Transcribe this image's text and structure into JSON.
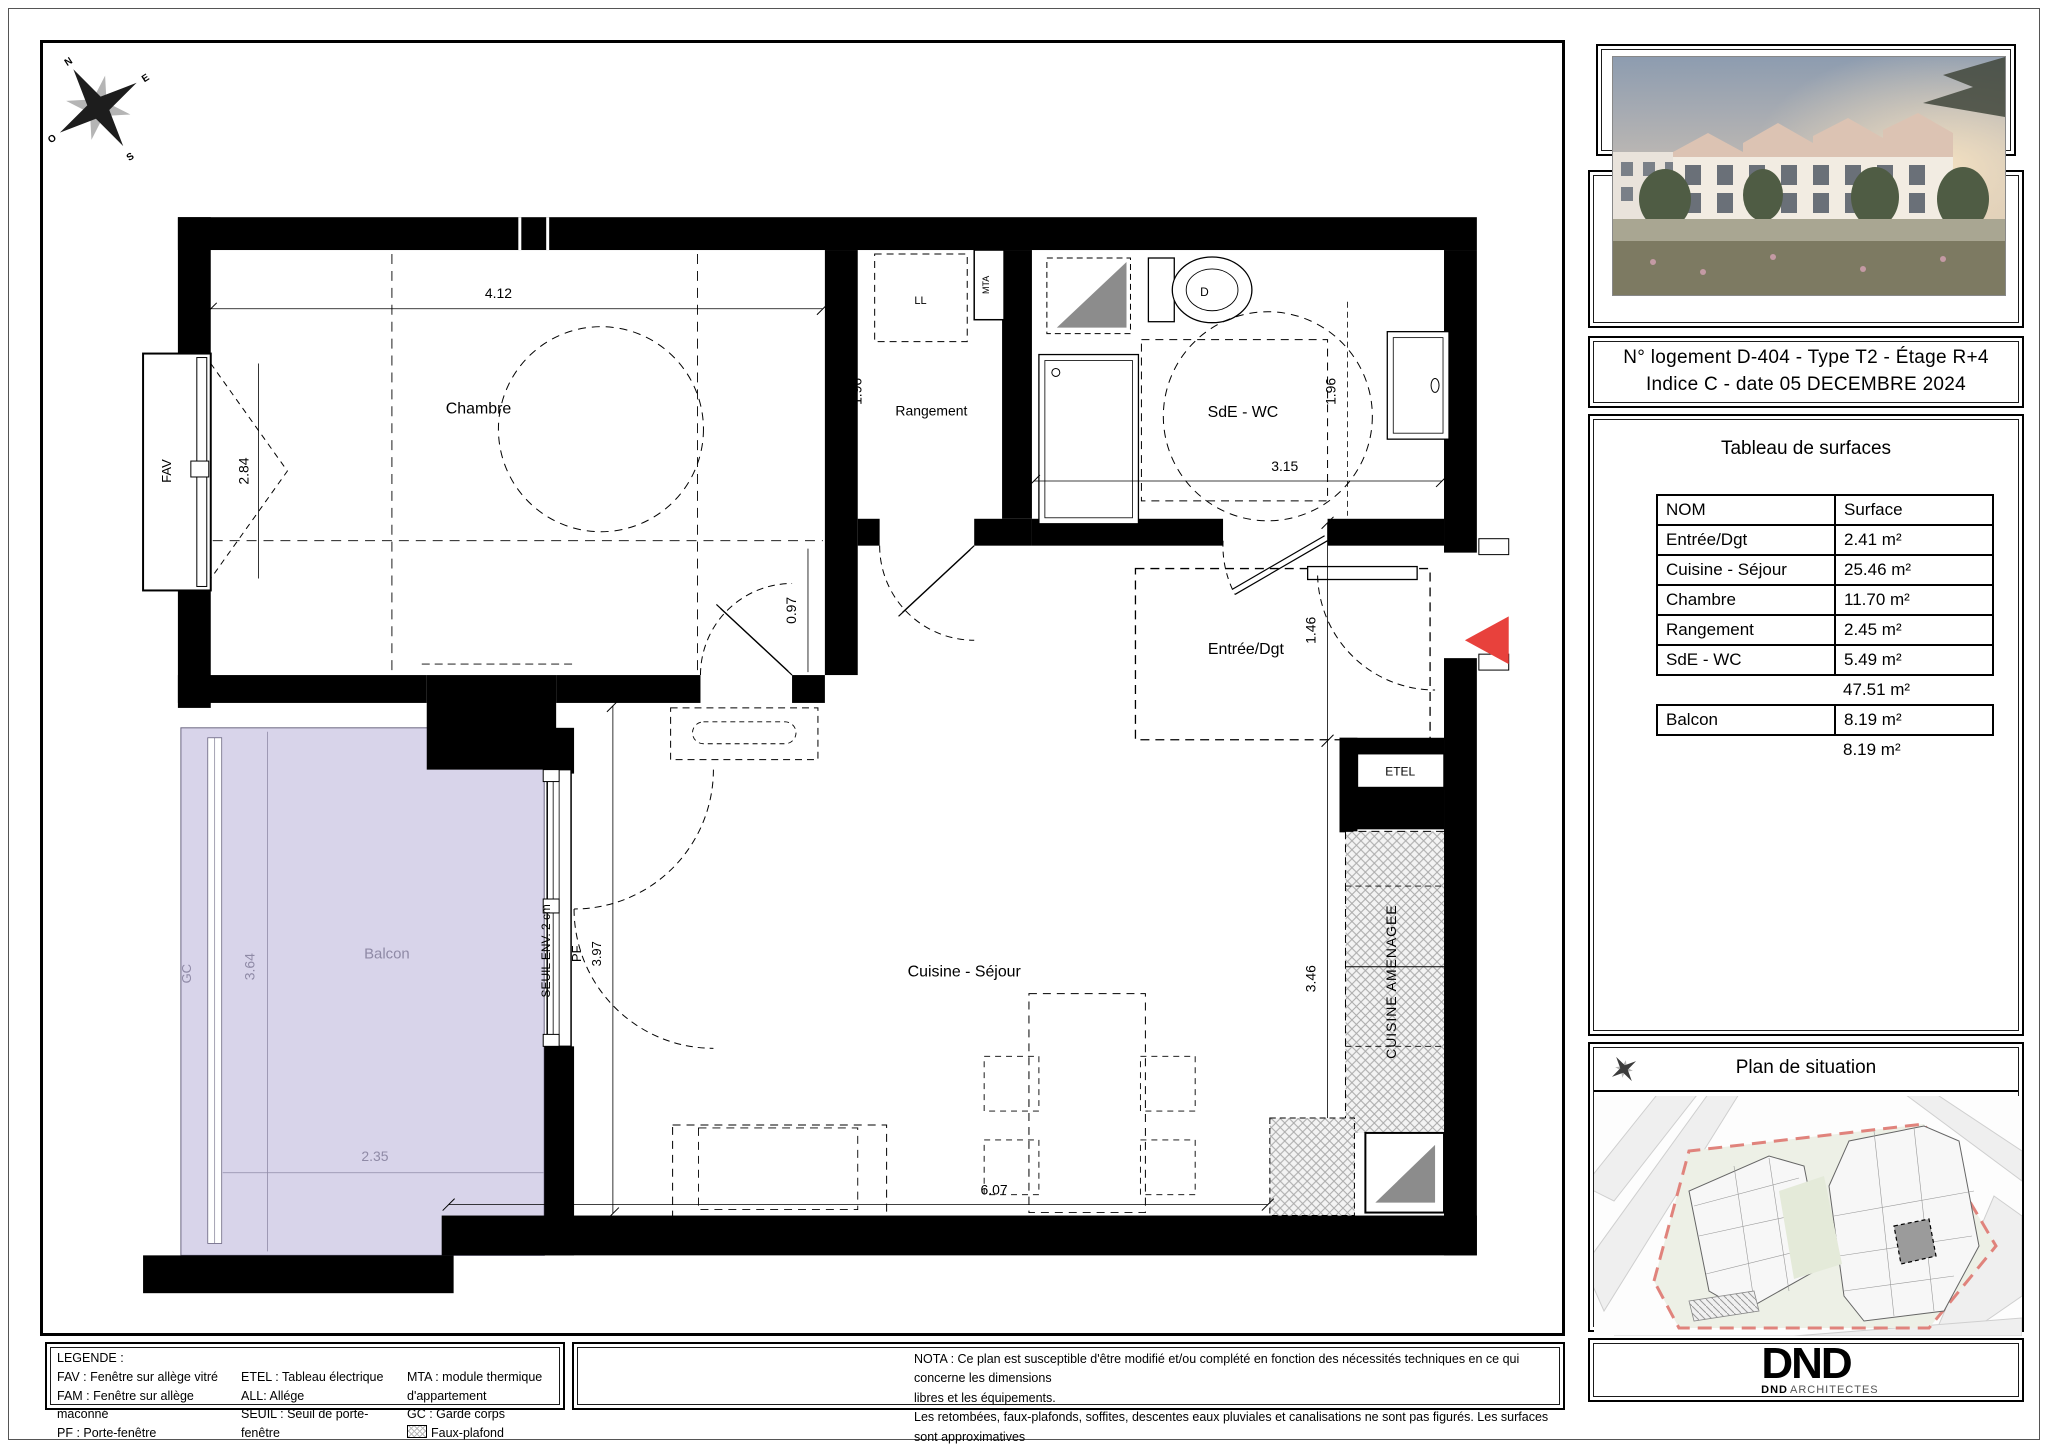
{
  "colors": {
    "wall": "#000000",
    "balcony_fill": "#d8d4ea",
    "balcony_text": "#8f8aa6",
    "entry_arrow": "#e8413c",
    "site_boundary": "#e0837c",
    "fixture_gray": "#8c8c8c"
  },
  "compass": {
    "n": "N",
    "e": "E",
    "s": "S",
    "o": "O"
  },
  "plan": {
    "rooms": {
      "chambre": "Chambre",
      "rangement": "Rangement",
      "sde_wc": "SdE - WC",
      "entree": "Entrée/Dgt",
      "cuisine_sejour": "Cuisine - Séjour",
      "balcon": "Balcon"
    },
    "dims": {
      "chambre_width": "4.12",
      "chambre_height": "2.84",
      "rangement_depth": "1.96",
      "sde_depth": "1.96",
      "sde_width": "3.15",
      "door_width": "0.97",
      "entree_depth": "1.46",
      "sejour_depth": "3.97",
      "cuisine_depth": "3.46",
      "sejour_width": "6.07",
      "balcon_depth": "3.64",
      "balcon_width": "2.35"
    },
    "annotations": {
      "fav": "FAV",
      "pf": "PF",
      "gc": "GC",
      "ll": "LL",
      "mta": "MTA",
      "etel": "ETEL",
      "wc": "D",
      "seuil": "SEUIL ENV. 2 cm",
      "cuisine_amenagee": "CUISINE AMENAGEE"
    }
  },
  "sidebar": {
    "unit_title_line1": "N° logement D-404 -  Type T2 -  Étage R+4",
    "unit_title_line2": "Indice C -  date 05 DECEMBRE 2024",
    "surfaces": {
      "title": "Tableau de surfaces",
      "col_nom": "NOM",
      "col_surface": "Surface",
      "rows": [
        {
          "nom": "Entrée/Dgt",
          "surface": "2.41 m²"
        },
        {
          "nom": "Cuisine - Séjour",
          "surface": "25.46 m²"
        },
        {
          "nom": "Chambre",
          "surface": "11.70 m²"
        },
        {
          "nom": "Rangement",
          "surface": "2.45 m²"
        },
        {
          "nom": "SdE - WC",
          "surface": "5.49 m²"
        }
      ],
      "total": "47.51 m²",
      "balcon_nom": "Balcon",
      "balcon_surface": "8.19 m²",
      "balcon_total": "8.19 m²"
    },
    "situation_title": "Plan de situation",
    "logo": {
      "mark": "DND",
      "sub_bold": "DND",
      "sub_light": "ARCHITECTES"
    }
  },
  "legend": {
    "title": "LEGENDE :",
    "col1": [
      "FAV : Fenêtre sur allège vitré",
      "FAM : Fenêtre sur allège maconné",
      "PF :  Porte-fenêtre"
    ],
    "col2": [
      "ETEL : Tableau électrique",
      "ALL: Allége",
      "SEUIL : Seuil de porte-fenêtre"
    ],
    "col3": [
      "MTA : module thermique d'appartement",
      "GC : Garde corps",
      "Faux-plafond"
    ]
  },
  "nota": {
    "line1": "NOTA : Ce plan est susceptible d'être modifié et/ou complété en fonction des nécessités techniques en ce qui concerne les dimensions",
    "line2": "libres et les équipements.",
    "line3": "Les retombées, faux-plafonds, soffites, descentes eaux pluviales et canalisations ne sont pas figurés. Les surfaces sont approximatives"
  }
}
